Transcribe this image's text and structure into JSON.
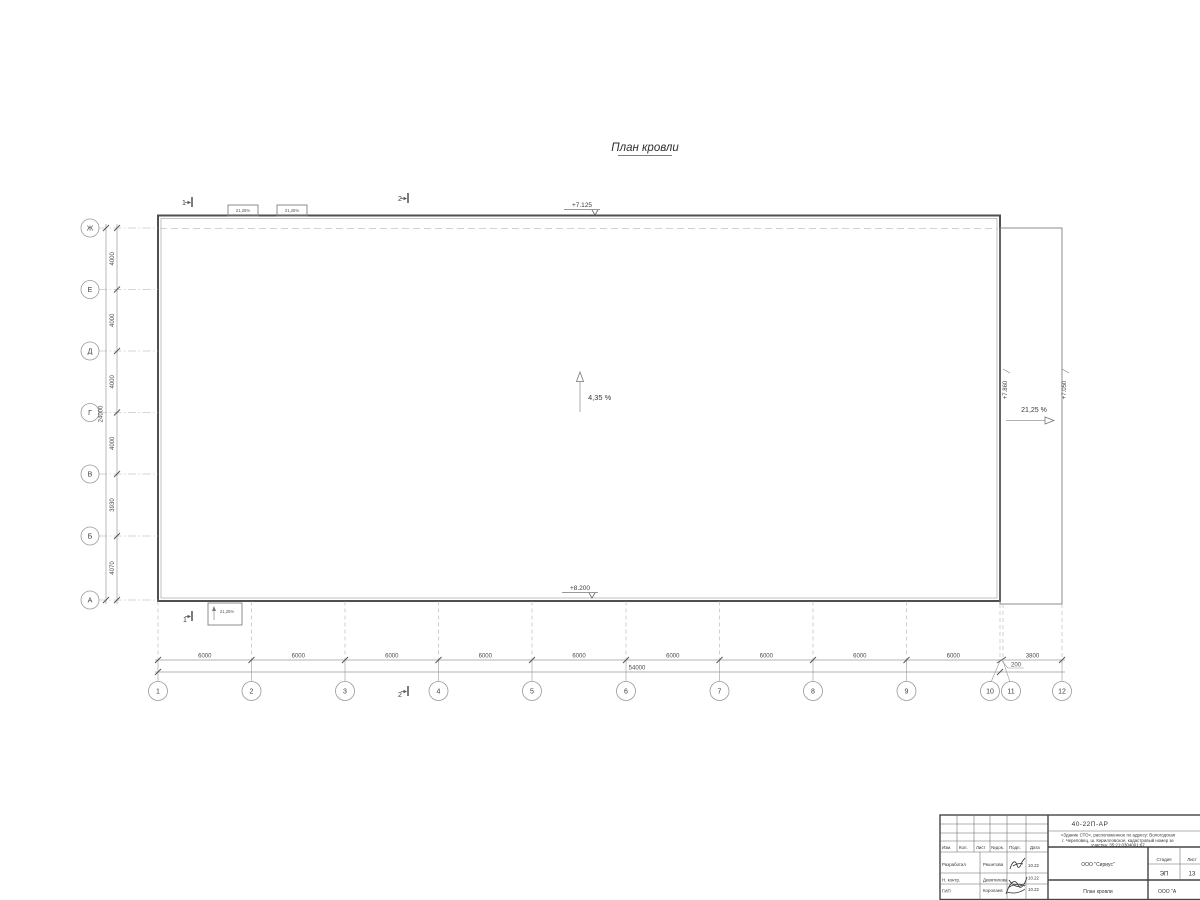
{
  "drawing": {
    "title": "План кровли"
  },
  "grid": {
    "rows": [
      "Ж",
      "Е",
      "Д",
      "Г",
      "В",
      "Б",
      "А"
    ],
    "row_dims": [
      "4000",
      "4000",
      "4000",
      "4000",
      "3930",
      "4070"
    ],
    "row_total": "24000",
    "cols": [
      "1",
      "2",
      "3",
      "4",
      "5",
      "6",
      "7",
      "8",
      "9",
      "10",
      "11",
      "12"
    ],
    "col_dims": [
      "6000",
      "6000",
      "6000",
      "6000",
      "6000",
      "6000",
      "6000",
      "6000",
      "6000"
    ],
    "col_dim_right": "3800",
    "col_gap": "200",
    "col_total": "54000"
  },
  "slopes": {
    "main": "4,35 %",
    "right": "21,25 %",
    "canopy_a": "21,25%",
    "canopy_b": "21,25%",
    "canopy_c": "21,25%"
  },
  "elevations": {
    "top": "+7.125",
    "bottom": "+8.200",
    "canopy_high": "+7.860",
    "canopy_low": "+7.050"
  },
  "sections": {
    "one": "1",
    "two": "2"
  },
  "titleblock": {
    "doc_number": "40-22П-АР",
    "description": [
      "«Здание СТО», расположенное по адресу: Вологодская",
      "г. Череповец, ш. Кирилловское, кадастровый номер зе",
      "участка: 35:21:0304001:67"
    ],
    "header_cols": [
      "Изм.",
      "Кол.",
      "Лист",
      "№док.",
      "Подп.",
      "Дата"
    ],
    "roles": [
      {
        "role": "Разработал",
        "name": "Решетова",
        "date": "10.22"
      },
      {
        "role": "Н. контр.",
        "name": "Девятилова",
        "date": "10.22"
      },
      {
        "role": "ГИП",
        "name": "Королаев",
        "date": "10.22"
      }
    ],
    "company": "ООО \"Сириус\"",
    "stage_label": "Стадия",
    "sheet_label": "Лист",
    "stage": "ЭП",
    "sheet": "13",
    "sheet_title": "План кровли",
    "company2": "ООО \"А"
  }
}
